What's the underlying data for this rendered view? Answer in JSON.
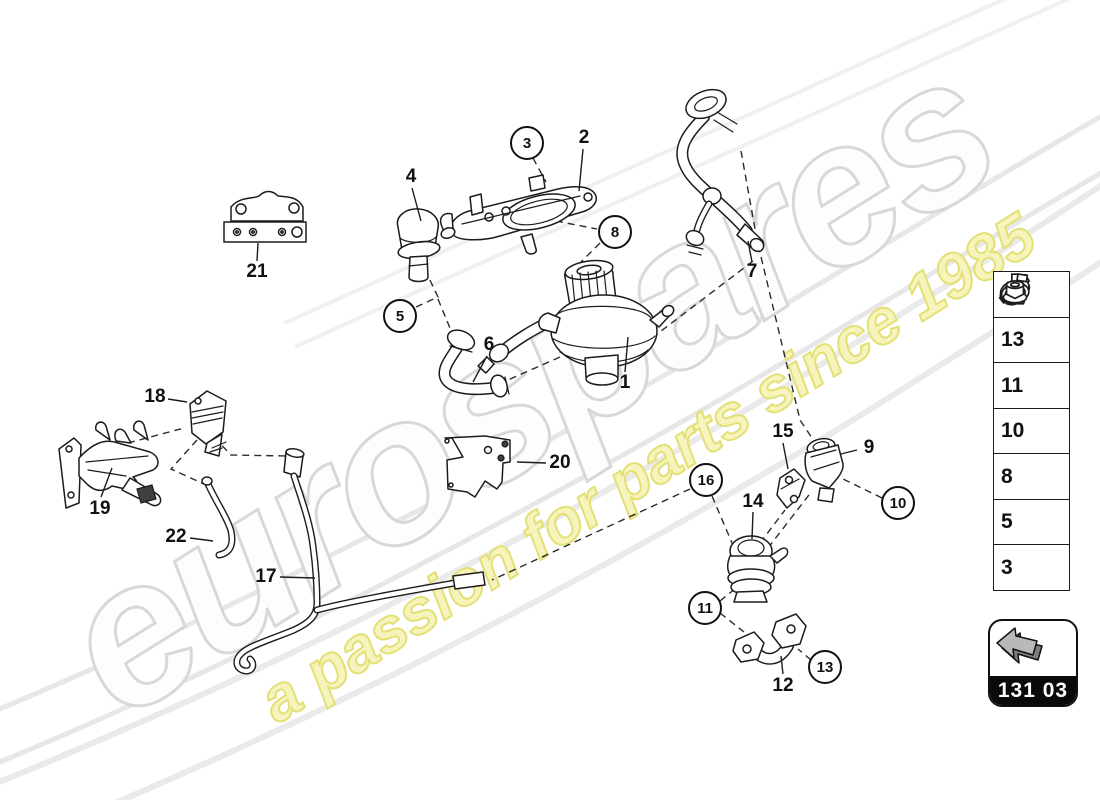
{
  "watermark": {
    "brand": "eurospares",
    "tagline": "a passion for parts since 1985",
    "brand_fill": "#fdfdfd",
    "brand_outline_color": "#d8d8d8",
    "tagline_fill": "#f6f4bc",
    "tagline_outline_color": "#e3e076"
  },
  "diagram": {
    "callouts_plain": [
      {
        "label": "21",
        "x": 257,
        "y": 272
      },
      {
        "label": "4",
        "x": 411,
        "y": 177
      },
      {
        "label": "2",
        "x": 584,
        "y": 138
      },
      {
        "label": "7",
        "x": 752,
        "y": 272
      },
      {
        "label": "6",
        "x": 489,
        "y": 345
      },
      {
        "label": "1",
        "x": 625,
        "y": 383
      },
      {
        "label": "18",
        "x": 155,
        "y": 397
      },
      {
        "label": "19",
        "x": 100,
        "y": 509
      },
      {
        "label": "22",
        "x": 176,
        "y": 537
      },
      {
        "label": "17",
        "x": 266,
        "y": 577
      },
      {
        "label": "20",
        "x": 560,
        "y": 463
      },
      {
        "label": "15",
        "x": 783,
        "y": 432
      },
      {
        "label": "9",
        "x": 869,
        "y": 448
      },
      {
        "label": "14",
        "x": 753,
        "y": 502
      },
      {
        "label": "12",
        "x": 783,
        "y": 686
      }
    ],
    "callouts_circled": [
      {
        "label": "3",
        "x": 527,
        "y": 143
      },
      {
        "label": "5",
        "x": 400,
        "y": 316
      },
      {
        "label": "8",
        "x": 615,
        "y": 232
      },
      {
        "label": "16",
        "x": 706,
        "y": 480
      },
      {
        "label": "10",
        "x": 898,
        "y": 503
      },
      {
        "label": "11",
        "x": 705,
        "y": 608
      },
      {
        "label": "13",
        "x": 825,
        "y": 667
      }
    ]
  },
  "sidebar": {
    "items": [
      {
        "number": "16",
        "icon": "hose-clip-icon"
      },
      {
        "number": "13",
        "icon": "flange-bolt-icon"
      },
      {
        "number": "11",
        "icon": "gasket-icon"
      },
      {
        "number": "10",
        "icon": "banjo-bolt-icon"
      },
      {
        "number": "8",
        "icon": "rubber-mount-icon"
      },
      {
        "number": "5",
        "icon": "hose-clamp-icon"
      },
      {
        "number": "3",
        "icon": "flange-nut-icon"
      }
    ]
  },
  "legend": {
    "code": "131 03",
    "icon": "back-arrow-icon"
  }
}
